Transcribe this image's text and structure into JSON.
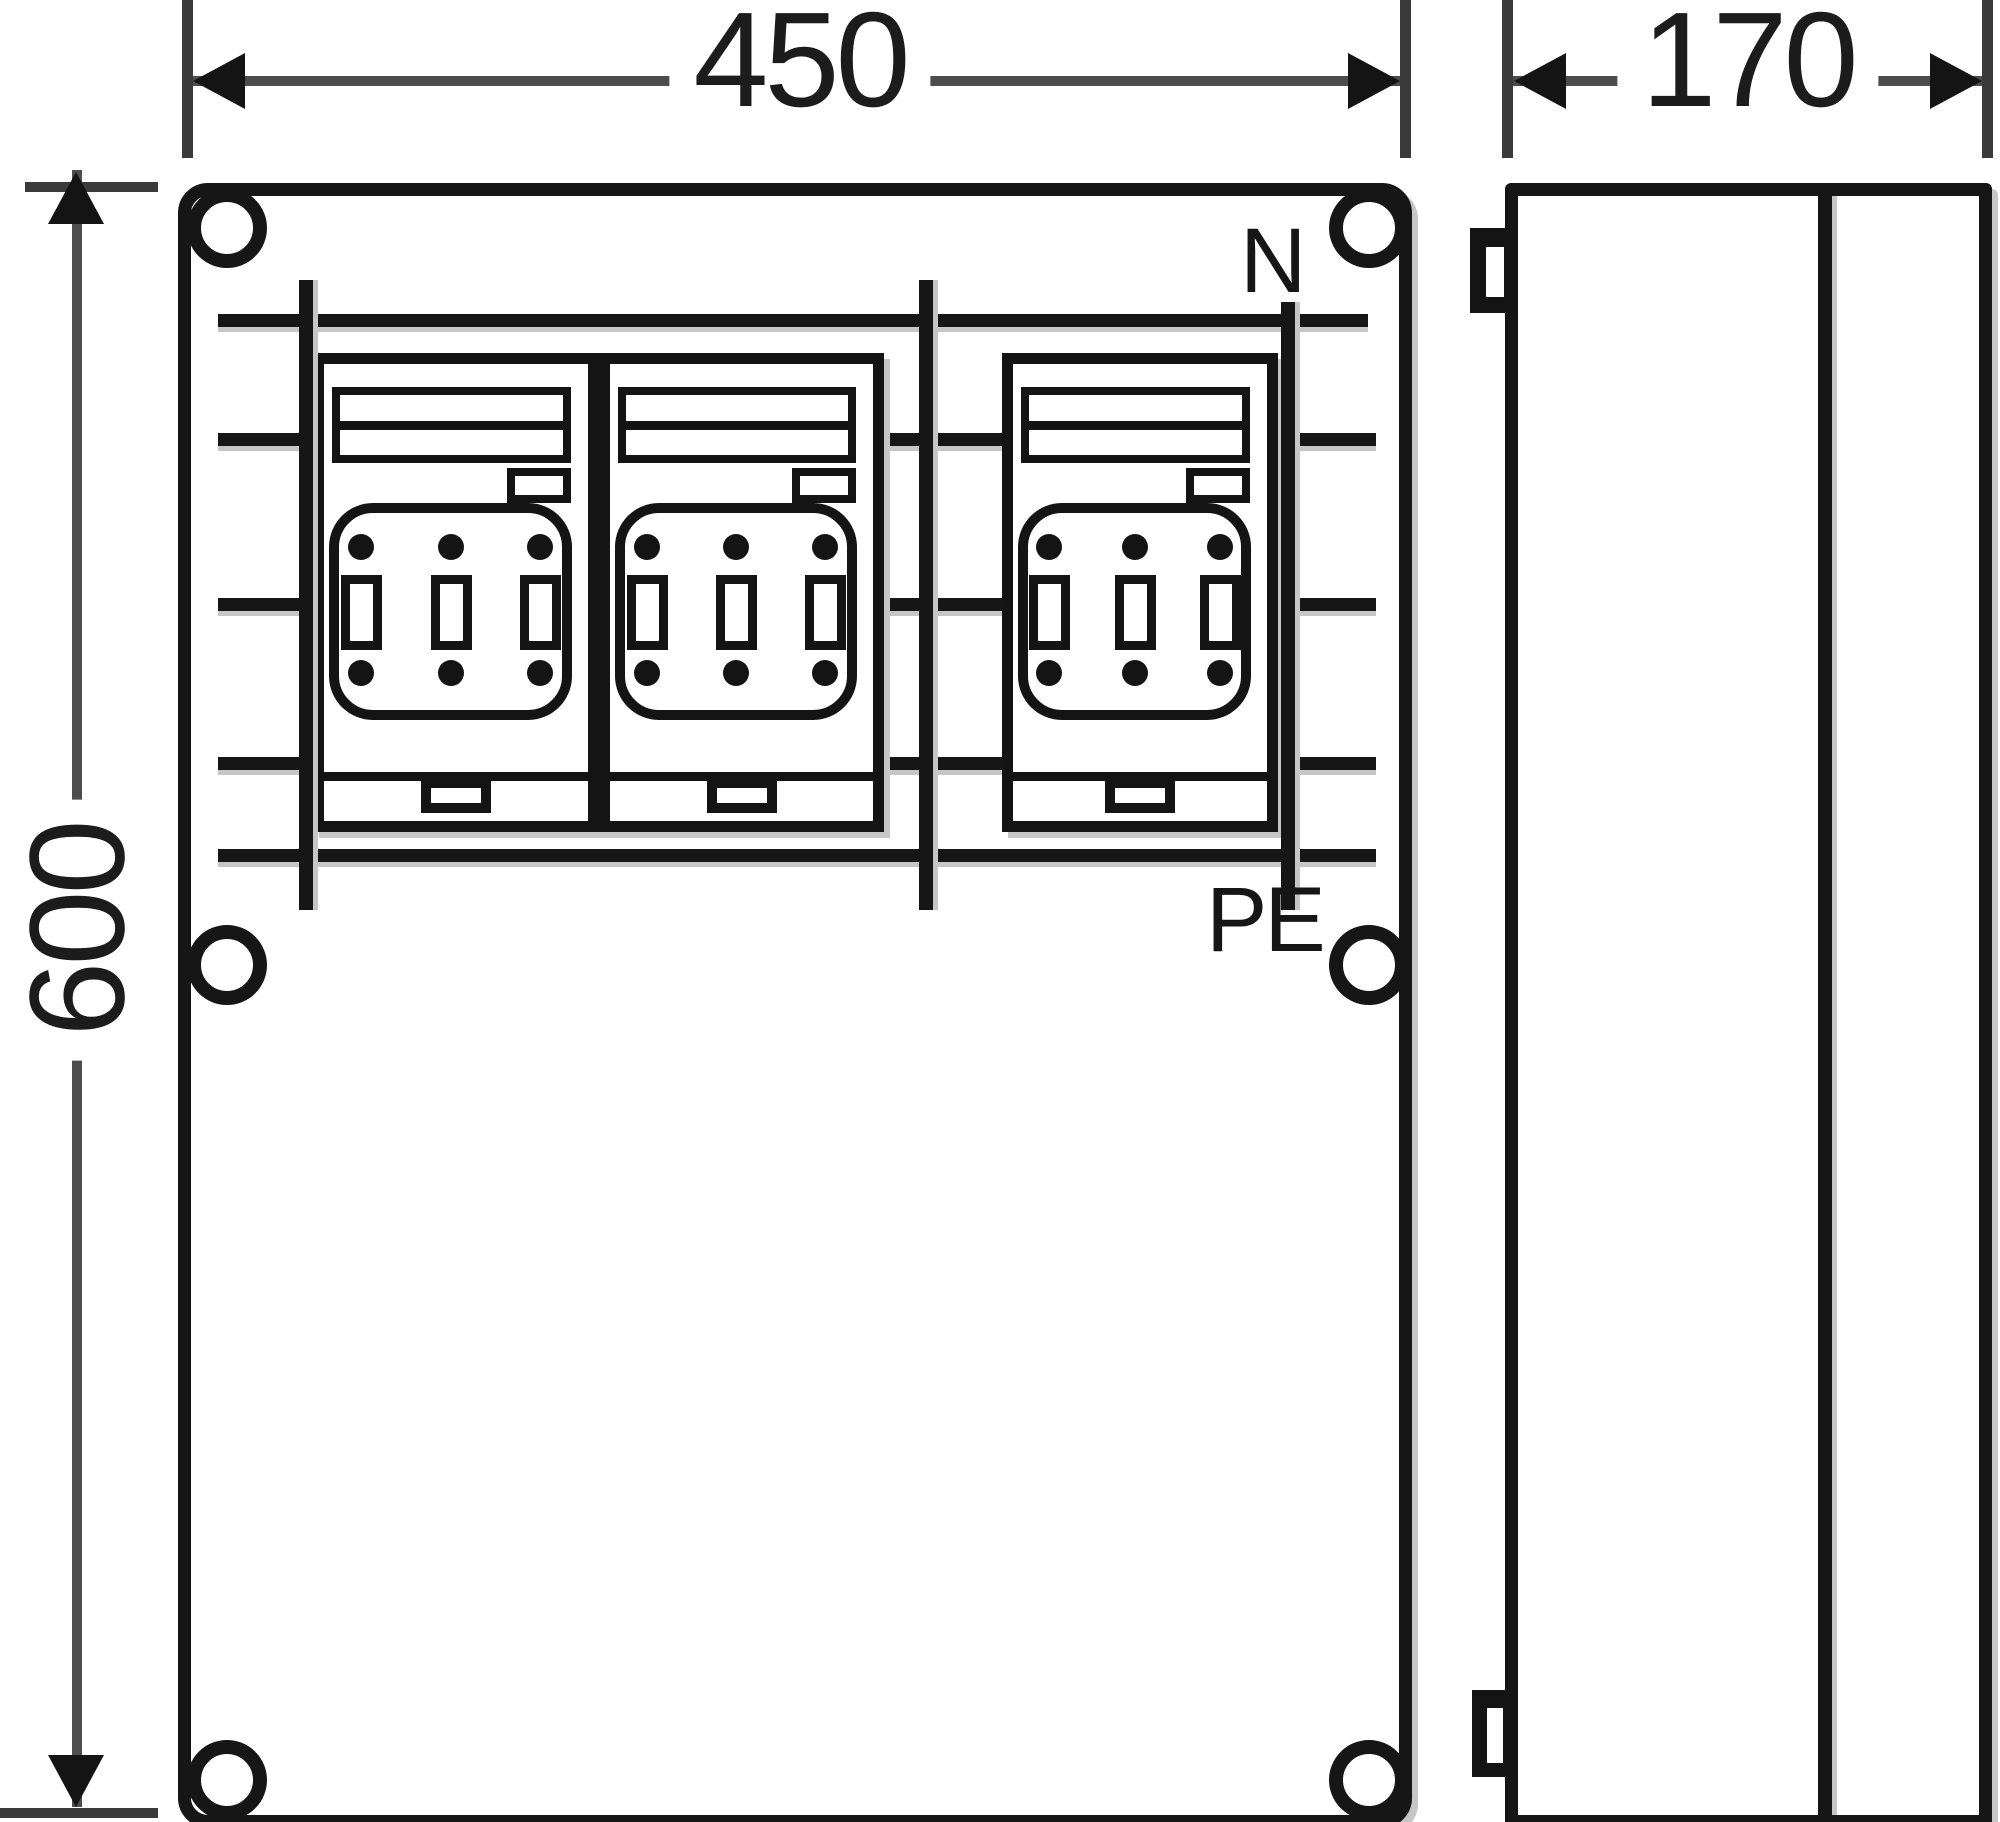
{
  "labels": {
    "dim_width": "450",
    "dim_height": "600",
    "dim_depth": "170",
    "neutral": "N",
    "protective_earth": "PE"
  },
  "views": {
    "front": {
      "fuse_switch_count": 3,
      "mounting_hole_count": 6,
      "busbar_row_count": 5
    },
    "side": {
      "hinge_lug_count": 2
    }
  },
  "colors": {
    "line": "#161616",
    "dimension_line": "#4d4d4d",
    "shadow": "#c6c6c6",
    "background": "#ffffff"
  }
}
